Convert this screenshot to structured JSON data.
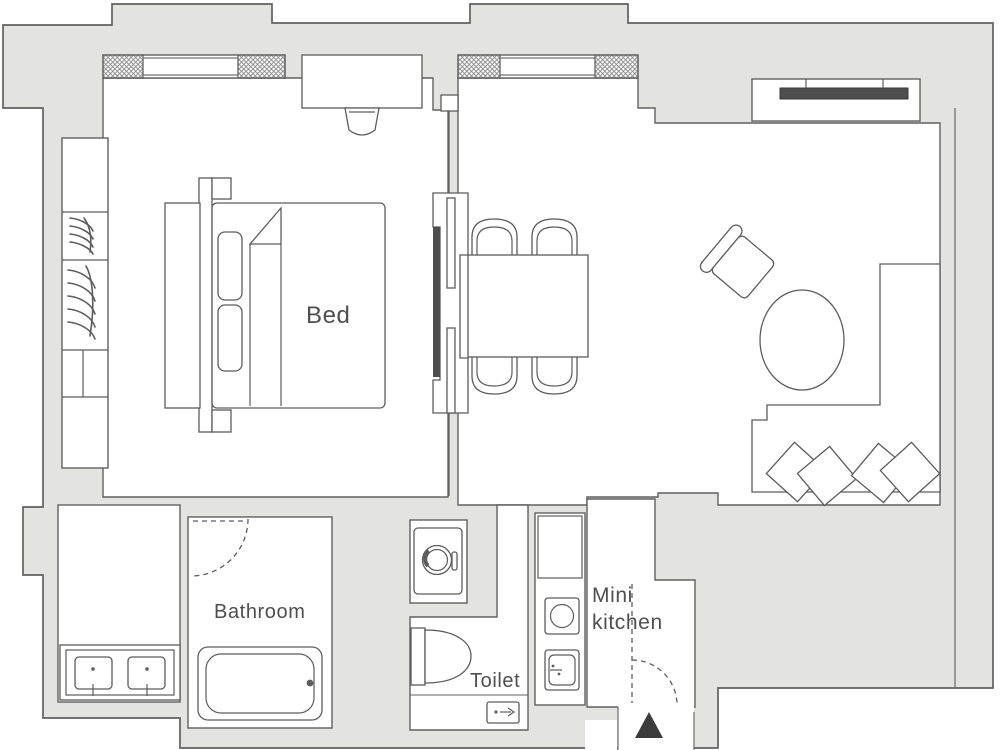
{
  "plan": {
    "rooms": {
      "bedroom": {
        "label": "Bed"
      },
      "bathroom": {
        "label": "Bathroom"
      },
      "toilet": {
        "label": "Toilet"
      },
      "kitchen": {
        "label_line1": "Mini",
        "label_line2": "kitchen"
      }
    },
    "colors": {
      "background": "#ffffff",
      "wall_fill": "#e3e3e1",
      "outline": "#606060",
      "furniture_line": "#5c5c5c",
      "label_text": "#4f4f4f",
      "tv_bar": "#4e4e4e",
      "entrance_marker": "#3c3c3c"
    },
    "furniture_icons": [
      "double-bed",
      "pillow",
      "wardrobe-hangers",
      "desk",
      "desk-chair",
      "sliding-partition",
      "dining-table",
      "dining-chair",
      "armchair",
      "coffee-table",
      "corner-sofa",
      "cushion",
      "tv-console",
      "washing-machine",
      "toilet-bowl",
      "hand-basin",
      "bathtub",
      "double-sink-vanity",
      "kitchenette-sink",
      "kitchenette-stove",
      "window",
      "door-swing",
      "entrance-marker"
    ]
  }
}
